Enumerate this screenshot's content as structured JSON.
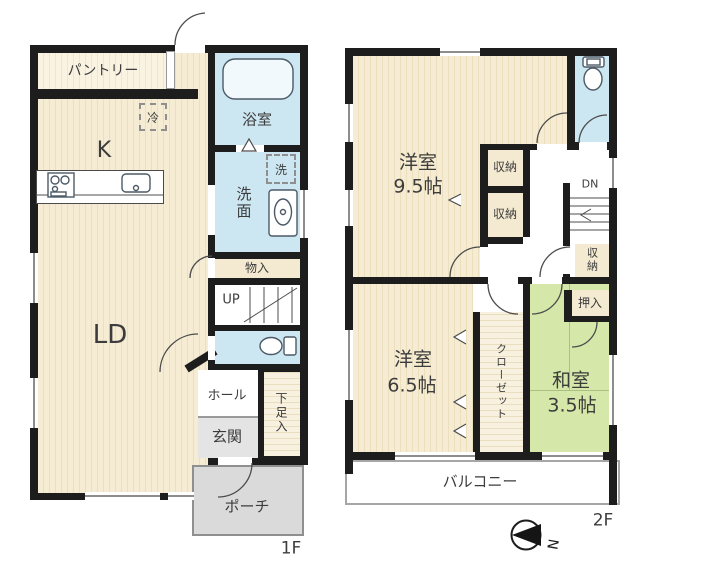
{
  "floor1": {
    "floor_label": "1F",
    "pantry_label": "パントリー",
    "fridge_label": "冷",
    "kitchen_label": "K",
    "bath_label": "浴室",
    "washer_label": "洗",
    "washroom_label": "洗面",
    "storage_label": "物入",
    "stairs_label": "UP",
    "living_dining_label": "LD",
    "hall_label": "ホール",
    "entrance_label": "玄関",
    "shoe_closet_label": "下足入",
    "porch_label": "ポーチ"
  },
  "floor2": {
    "floor_label": "2F",
    "western_room_large_name": "洋室",
    "western_room_large_size": "9.5帖",
    "storage_a_label": "収納",
    "storage_b_label": "収納",
    "stairs_label": "DN",
    "storage_c_label": "収納",
    "oshiire_label": "押入",
    "western_room_small_name": "洋室",
    "western_room_small_size": "6.5帖",
    "closet_label": "クローゼット",
    "japanese_room_name": "和室",
    "japanese_room_size": "3.5帖",
    "balcony_label": "バルコニー"
  },
  "compass": {
    "north_label": "N"
  },
  "colors": {
    "wall": "#1d1d1d",
    "room_cream": "#f5ebd0",
    "wet_area_blue": "#cde7f2",
    "tatami_green": "#d5e8a9",
    "porch_gray": "#dadada"
  }
}
